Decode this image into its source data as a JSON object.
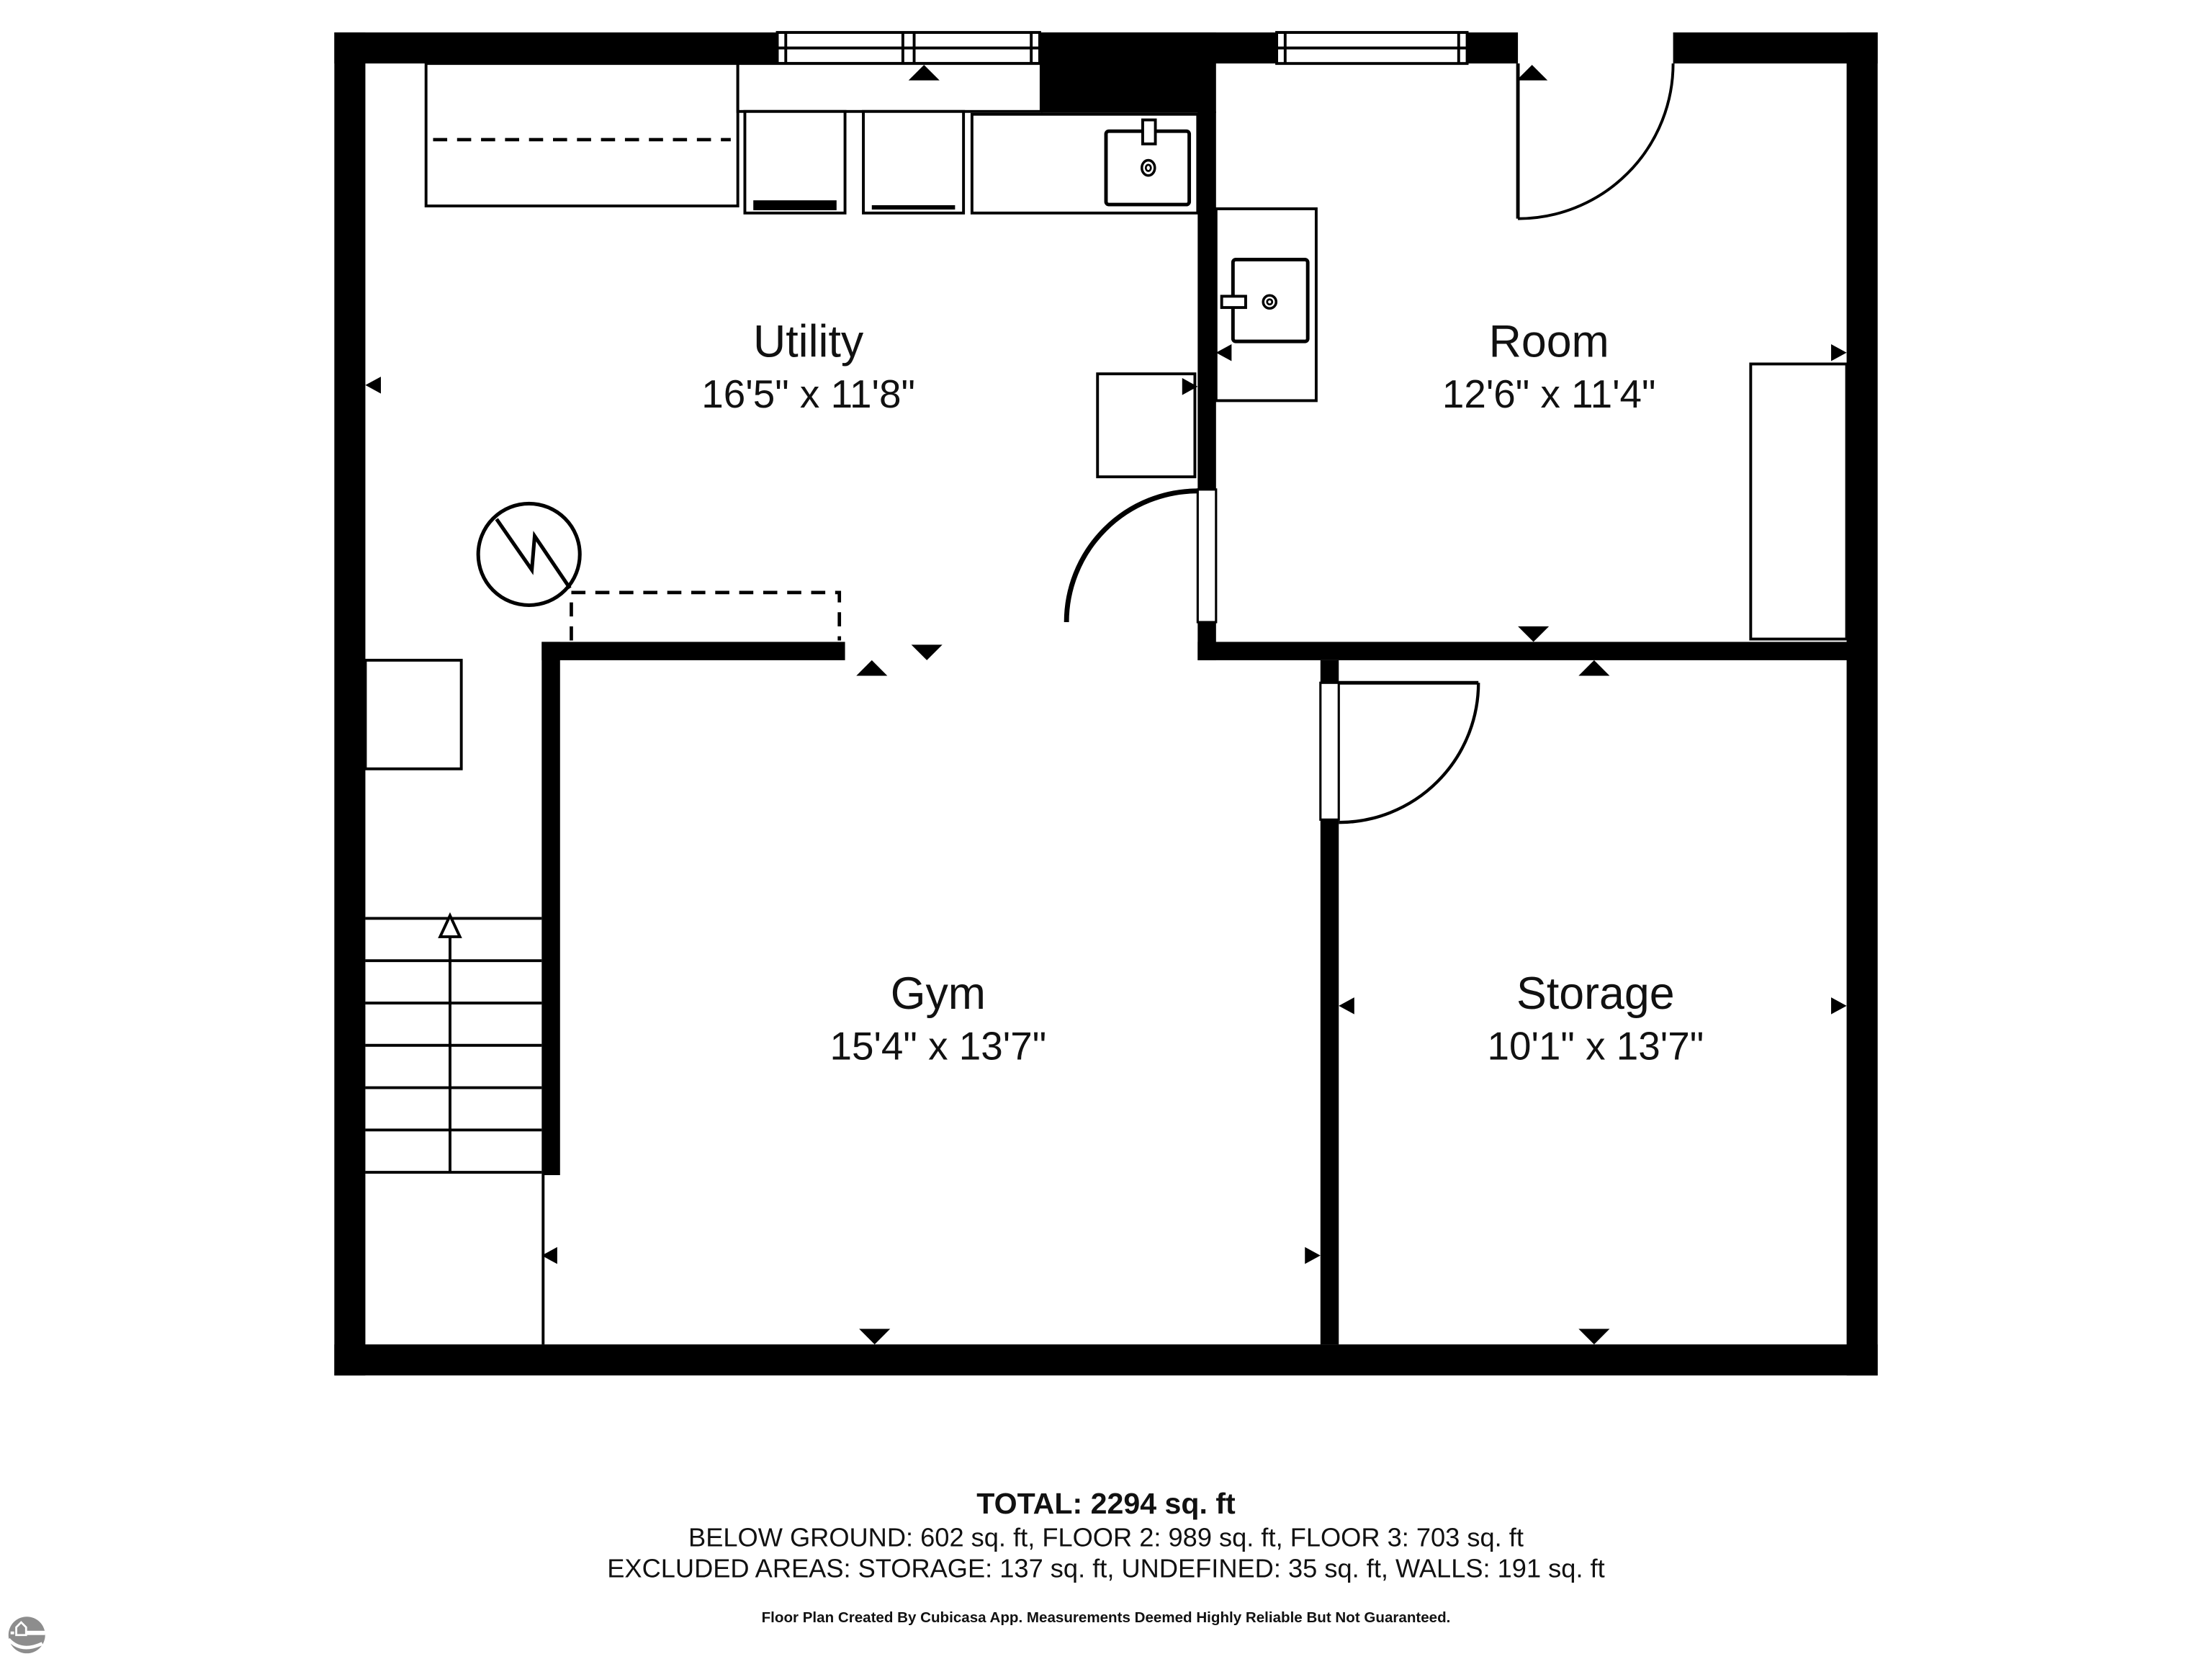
{
  "floor_plan": {
    "rooms": [
      {
        "name": "Utility",
        "dimensions": "16'5\" x 11'8\""
      },
      {
        "name": "Room",
        "dimensions": "12'6\" x 11'4\""
      },
      {
        "name": "Gym",
        "dimensions": "15'4\" x 13'7\""
      },
      {
        "name": "Storage",
        "dimensions": "10'1\" x 13'7\""
      }
    ]
  },
  "summary": {
    "total": "TOTAL: 2294 sq. ft",
    "floors": "BELOW GROUND: 602 sq. ft, FLOOR 2: 989 sq. ft, FLOOR 3: 703 sq. ft",
    "excluded_areas": "EXCLUDED AREAS: STORAGE: 137 sq. ft, UNDEFINED: 35 sq. ft, WALLS: 191 sq. ft"
  },
  "disclaimer": "Floor Plan Created By Cubicasa App. Measurements Deemed Highly Reliable But Not Guaranteed.",
  "icons": {
    "window": "double-pane window symbol",
    "door": "quarter-circle swing arc",
    "stairs": "stair treads with up arrow",
    "sink": "basin with faucet and drain",
    "water_heater": "circle with zigzag",
    "measure_arrow": "small solid triangle",
    "cubicasa_logo": "gray circle with house and horizon"
  },
  "colors": {
    "walls": "#000000",
    "text": "#111111",
    "logo": "#8d8d8d",
    "background": "#ffffff"
  }
}
